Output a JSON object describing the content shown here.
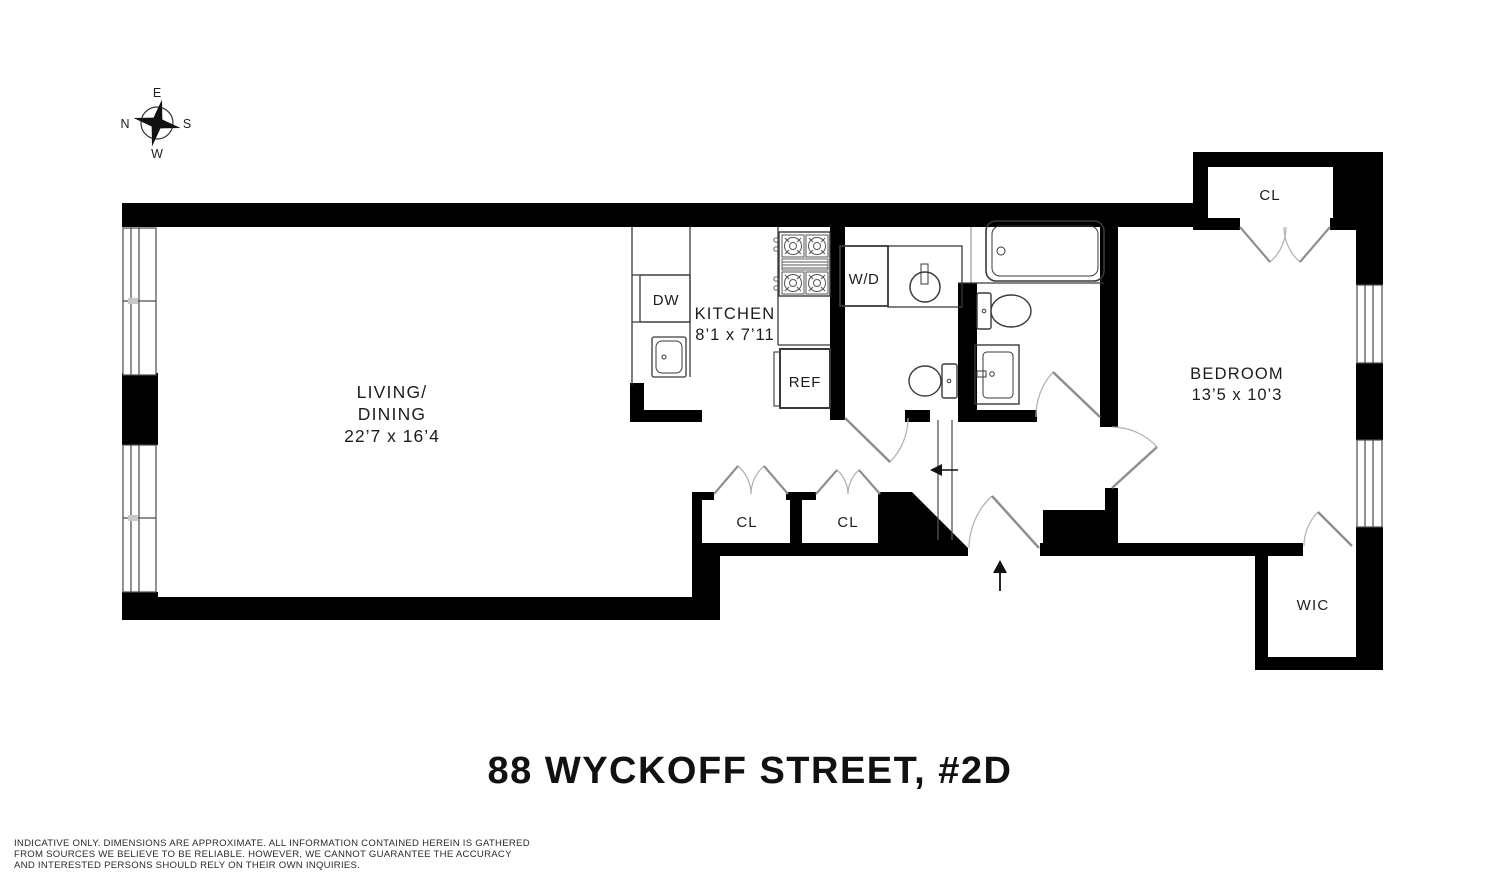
{
  "title": "88 WYCKOFF STREET, #2D",
  "disclaimer": {
    "line1": "INDICATIVE ONLY. DIMENSIONS ARE APPROXIMATE. ALL INFORMATION CONTAINED HEREIN IS GATHERED",
    "line2": "FROM SOURCES WE BELIEVE TO BE RELIABLE. HOWEVER, WE CANNOT GUARANTEE THE ACCURACY",
    "line3": "AND INTERESTED PERSONS SHOULD RELY ON THEIR OWN INQUIRIES."
  },
  "compass": {
    "top": "E",
    "right": "S",
    "bottom": "W",
    "left": "N"
  },
  "rooms": {
    "living_dining": {
      "line1": "LIVING/",
      "line2": "DINING",
      "dims": "22’7 x 16’4"
    },
    "kitchen": {
      "name": "KITCHEN",
      "dims": "8’1 x 7’11"
    },
    "bedroom": {
      "name": "BEDROOM",
      "dims": "13’5 x 10’3"
    }
  },
  "closets": {
    "hall_closet_1": "CL",
    "hall_closet_2": "CL",
    "bedroom_closet": "CL",
    "walk_in_closet": "WIC"
  },
  "appliances": {
    "washer_dryer": "W/D",
    "refrigerator": "REF",
    "dishwasher": "DW"
  },
  "colors": {
    "wall": "#000000",
    "background": "#ffffff",
    "door": "#8f8f8f",
    "fixture": "#3a3a3a",
    "text": "#1d1d1d"
  }
}
